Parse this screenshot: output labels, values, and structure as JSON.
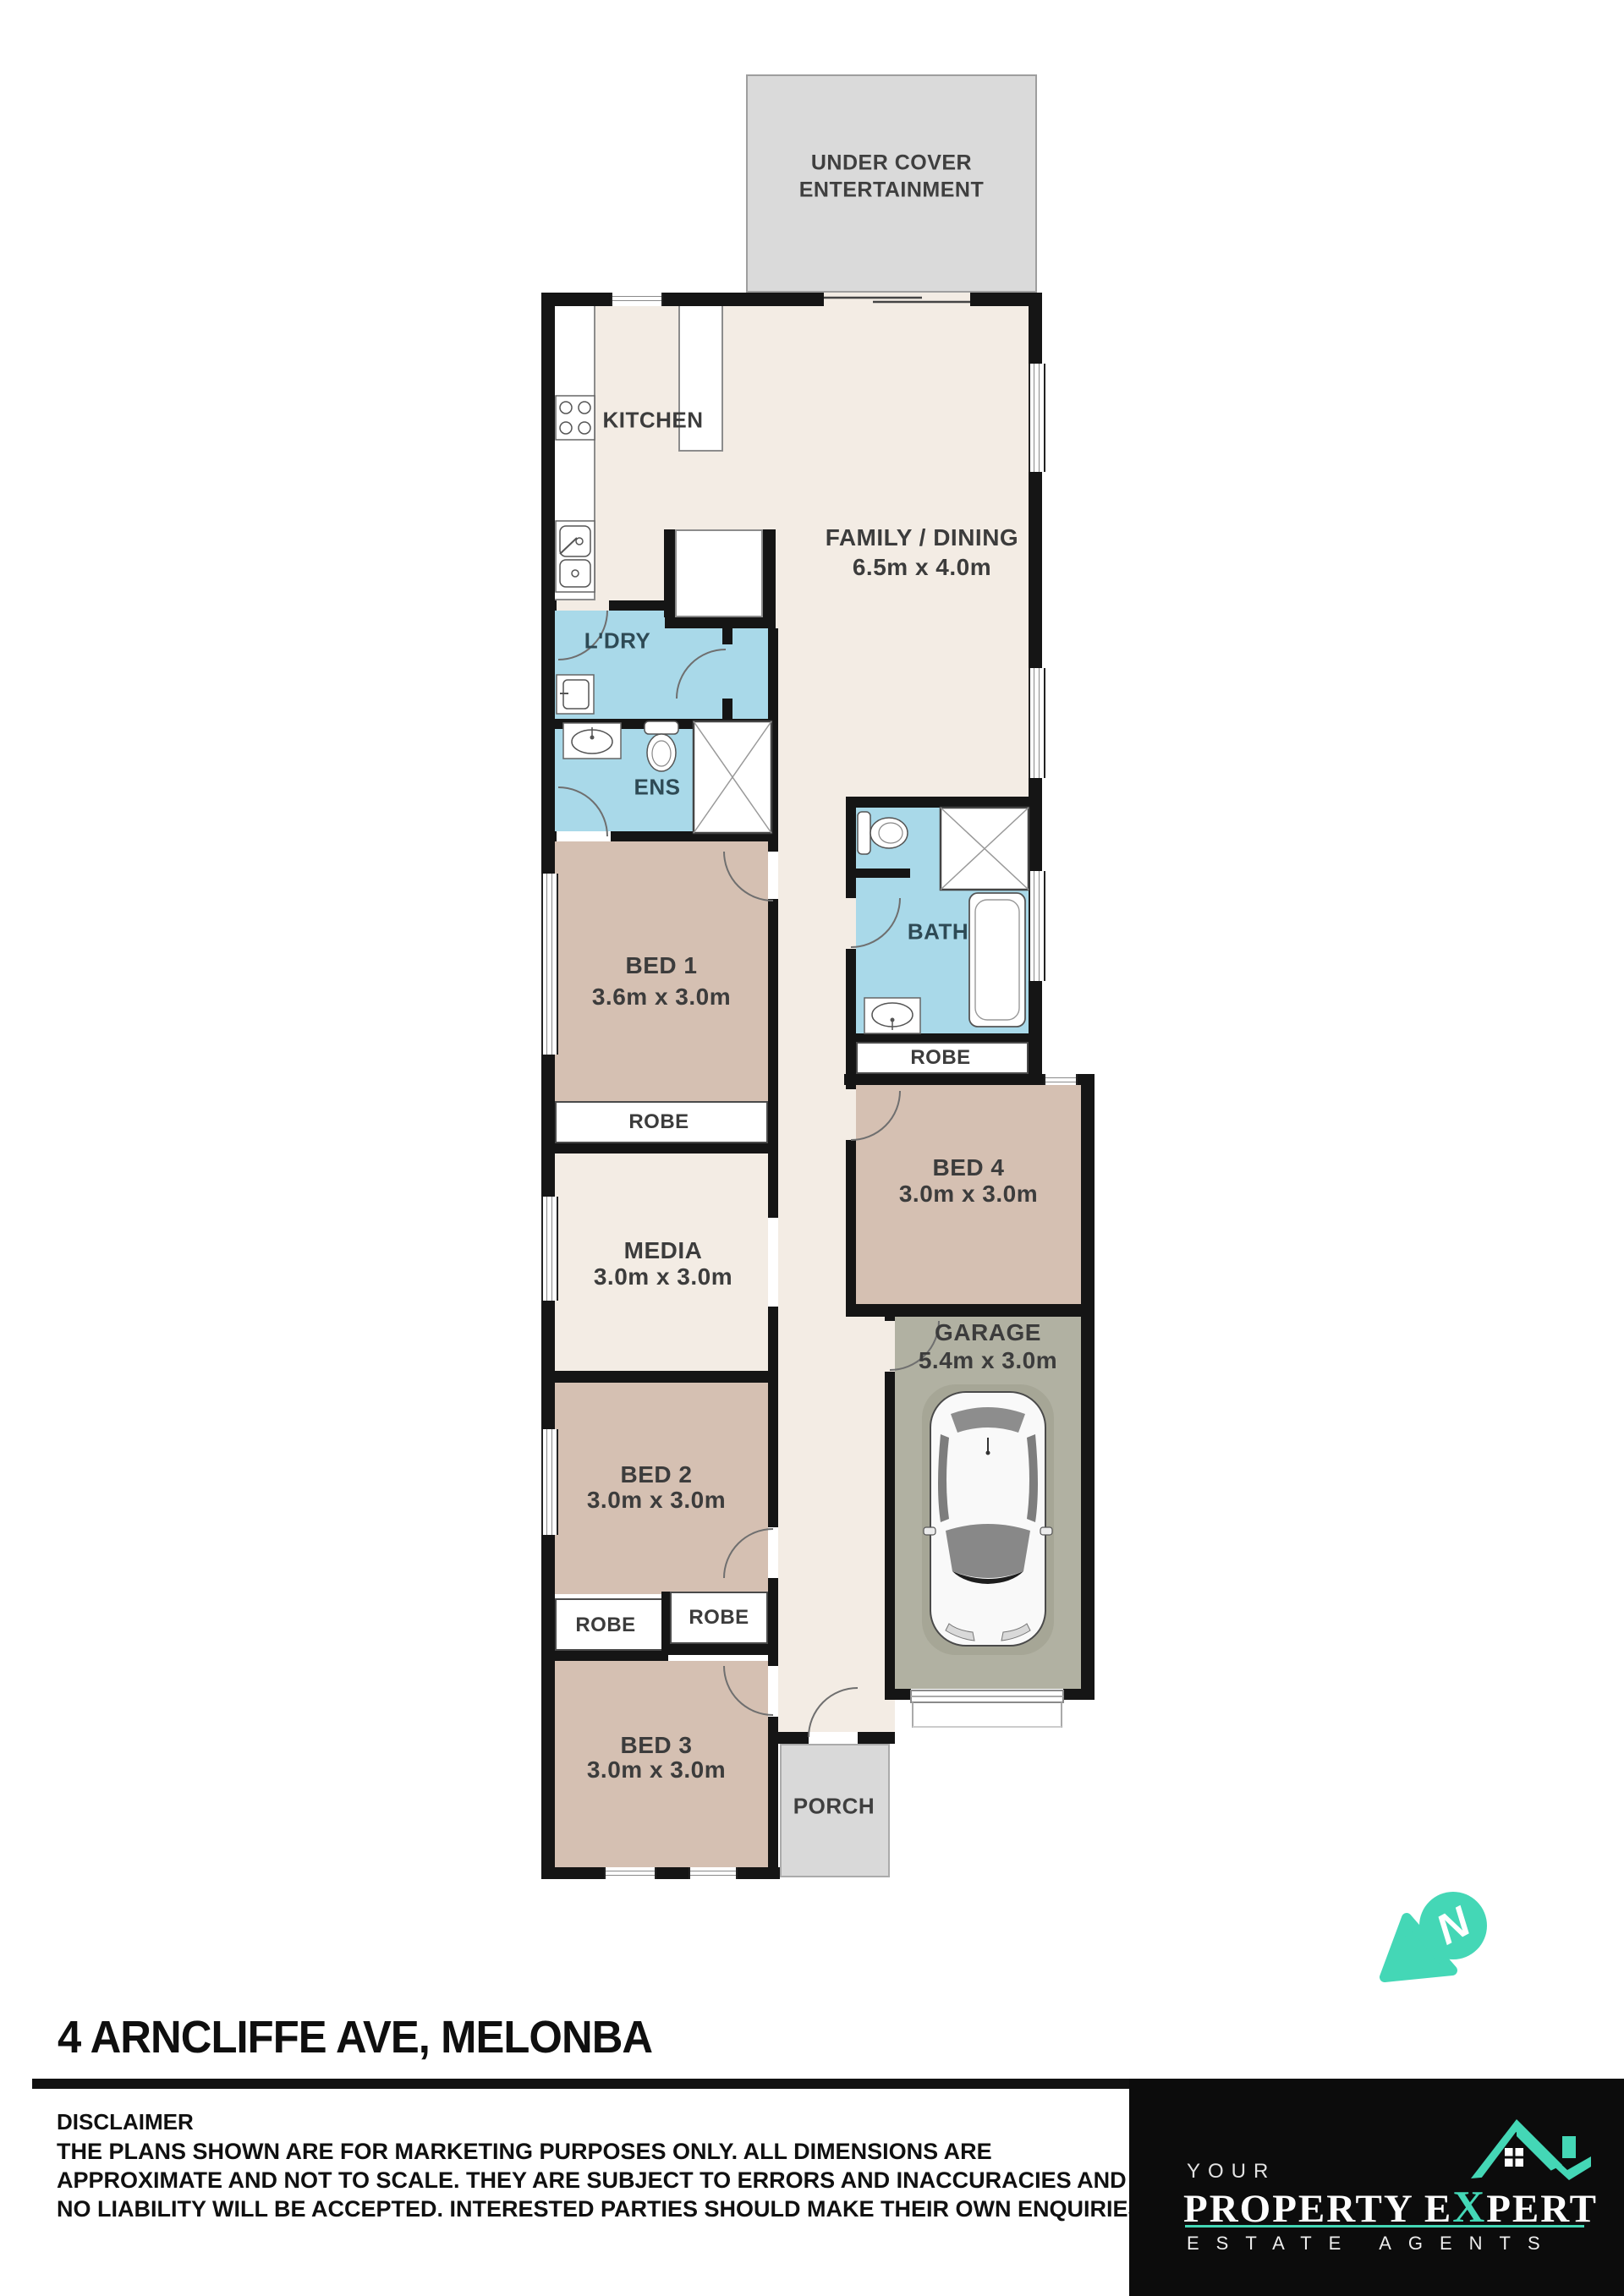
{
  "plan": {
    "compass_letter": "N",
    "rooms": {
      "entertainment": {
        "line1": "UNDER COVER",
        "line2": "ENTERTAINMENT"
      },
      "kitchen": {
        "name": "KITCHEN"
      },
      "family": {
        "name": "FAMILY / DINING",
        "dims": "6.5m x 4.0m"
      },
      "laundry": {
        "name": "L'DRY"
      },
      "ensuite": {
        "name": "ENS"
      },
      "bed1": {
        "name": "BED 1",
        "dims": "3.6m x 3.0m"
      },
      "robe_bed1": {
        "name": "ROBE"
      },
      "bath": {
        "name": "BATH"
      },
      "robe_bath": {
        "name": "ROBE"
      },
      "bed4": {
        "name": "BED 4",
        "dims": "3.0m x 3.0m"
      },
      "media": {
        "name": "MEDIA",
        "dims": "3.0m x 3.0m"
      },
      "garage": {
        "name": "GARAGE",
        "dims": "5.4m x 3.0m"
      },
      "bed2": {
        "name": "BED 2",
        "dims": "3.0m x 3.0m"
      },
      "robe_bed2_left": {
        "name": "ROBE"
      },
      "robe_bed2_right": {
        "name": "ROBE"
      },
      "bed3": {
        "name": "BED 3",
        "dims": "3.0m x 3.0m"
      },
      "porch": {
        "name": "PORCH"
      }
    },
    "icons": {
      "stove": "stove-cooktop-icon",
      "kitchen_sink": "double-sink-icon",
      "washer": "washing-machine-icon",
      "toilet": "toilet-icon",
      "vanity": "vanity-basin-icon",
      "shower": "shower-icon",
      "bathtub": "bathtub-icon",
      "car": "car-top-view-icon",
      "compass": "north-compass-icon"
    }
  },
  "footer": {
    "address_title": "4 ARNCLIFFE AVE, MELONBA",
    "disclaimer": {
      "heading": "DISCLAIMER",
      "line1": "THE PLANS SHOWN ARE FOR MARKETING PURPOSES ONLY. ALL DIMENSIONS ARE",
      "line2": "APPROXIMATE AND NOT TO SCALE. THEY ARE SUBJECT TO ERRORS AND INACCURACIES AND",
      "line3": "NO LIABILITY WILL BE ACCEPTED. INTERESTED PARTIES SHOULD MAKE THEIR OWN ENQUIRIES."
    },
    "logo": {
      "top_word": "YOUR",
      "main_prefix": "PROPERTY E",
      "main_x": "X",
      "main_suffix": "PERT",
      "tagline": "ESTATE AGENTS"
    }
  },
  "colors": {
    "wall": "#151515",
    "floor_living": "#f3ece4",
    "floor_bedroom": "#d5c0b2",
    "floor_wet": "#a9d9e9",
    "floor_garage": "#b1b1a2",
    "floor_outdoor": "#dadada",
    "brand_teal": "#44d7b6",
    "logo_background": "#0c0c0c"
  }
}
